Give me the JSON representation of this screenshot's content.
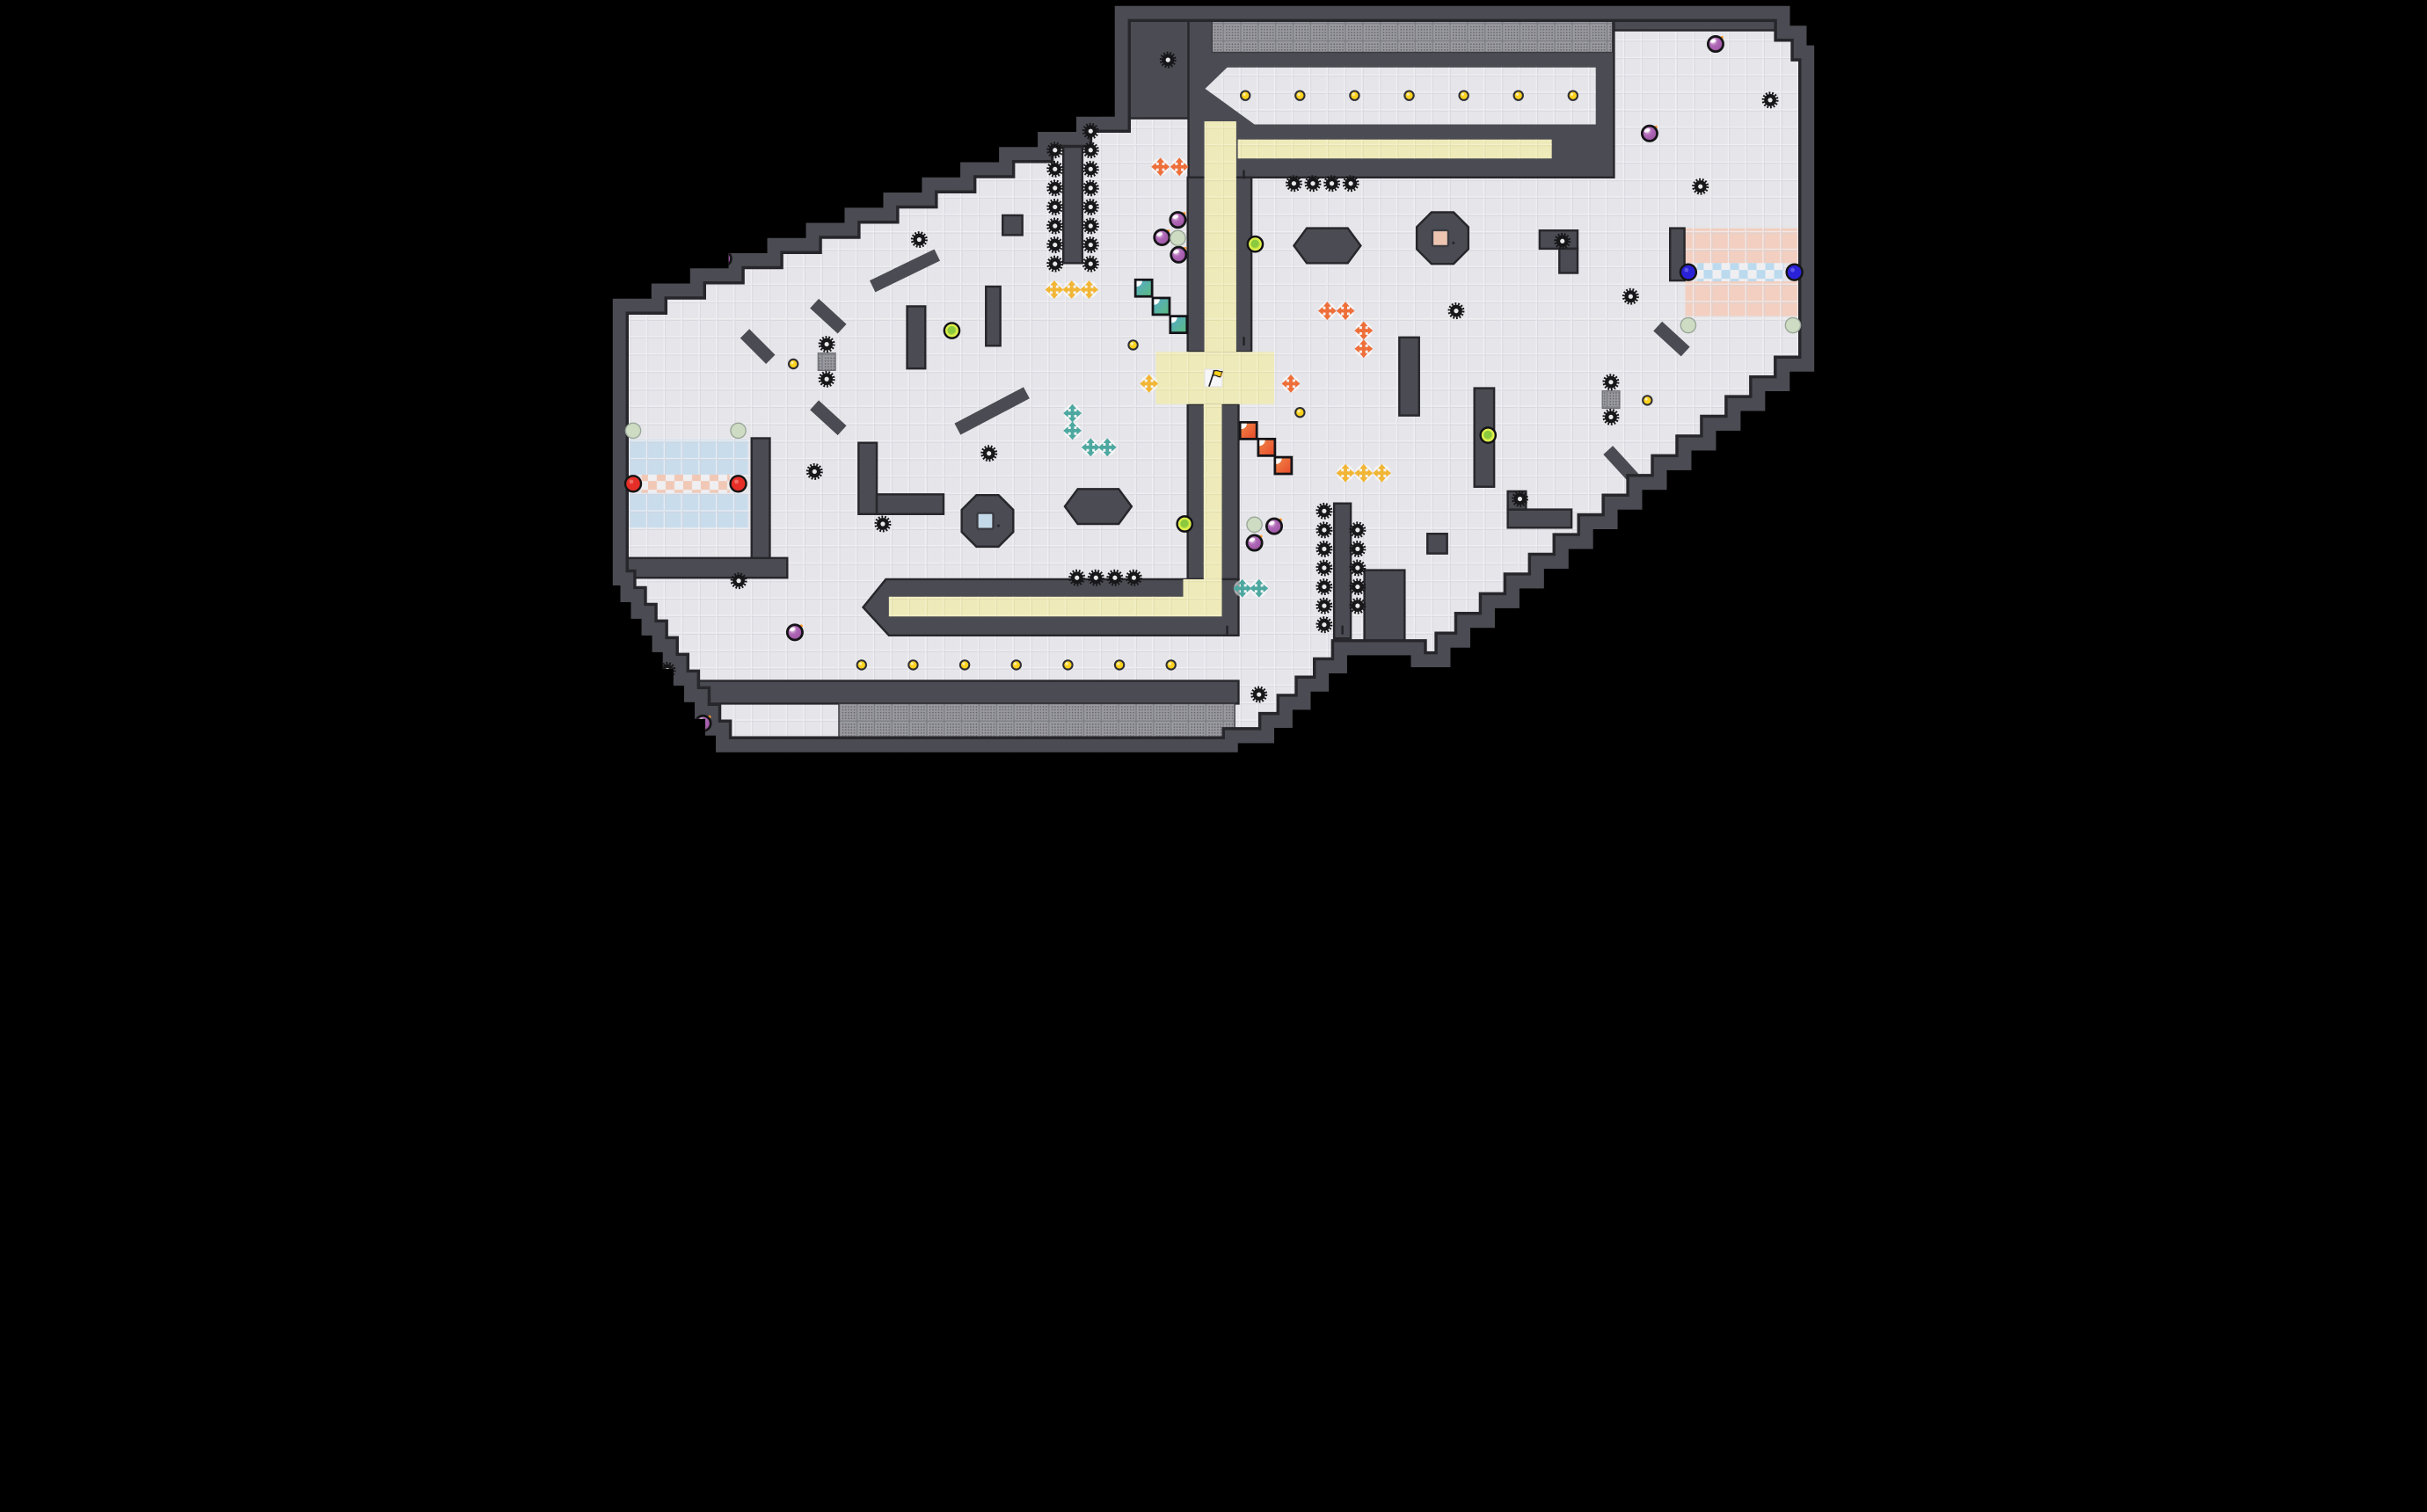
{
  "meta": {
    "view": "tile-level-map",
    "grid_cols": 80,
    "grid_rows": 50,
    "cell": 1.15
  },
  "palette": {
    "outside": "#000000",
    "floor": "#e6e6ea",
    "floor_line": "#d0d0d8",
    "wall": "#4b4b53",
    "wall_edge": "#26262b",
    "yellow_floor": "#eeeaba",
    "yellow_line": "#ddd79f",
    "blue_floor": "#c9dcec",
    "pink_floor": "#f2cfc0",
    "checker_pink": "#f1c8b6",
    "checker_blue": "#bcdaee",
    "checker_bg": "#efeff2",
    "hatch_bg": "#9a9aa0",
    "hatch_dot": "#64646b",
    "gold": "#ffd21e",
    "bomb_hi": "#f3e2ee",
    "bomb_mid": "#b06ab8",
    "bomb_edge": "#c06a88",
    "spark": "#ff9a2e",
    "gear": "#17171a",
    "gear_hole": "#e9e9ed",
    "powerup": "#dff04a",
    "powerup_core": "#8bc93e",
    "pale_circle": "#cddcc2",
    "boost_red": "#e62e28",
    "boost_blue": "#2a22d8",
    "cross_orange": "#ee6f3a",
    "cross_yellow": "#f2b636",
    "cross_teal": "#4da8a0",
    "fold_red_a": "#f08a48",
    "fold_red_b": "#e8482a",
    "fold_teal_a": "#55a8cf",
    "fold_teal_b": "#5cbc7c",
    "inset_blue": "#c3d9e9",
    "inset_pink": "#ecc4b0",
    "flag": "#ffd21e",
    "flag_tip": "#f5a623",
    "ink": "#1c1c1f"
  },
  "boundary": [
    [
      33.5,
      0.4
    ],
    [
      78,
      0.4
    ],
    [
      78,
      1.7
    ],
    [
      79.1,
      1.7
    ],
    [
      79.1,
      3.0
    ],
    [
      79.6,
      3.0
    ],
    [
      79.6,
      23.2
    ],
    [
      79.6,
      24.5
    ],
    [
      77.98,
      24.5
    ],
    [
      77.98,
      25.8
    ],
    [
      76.36,
      25.8
    ],
    [
      76.36,
      27.1
    ],
    [
      74.74,
      27.1
    ],
    [
      74.74,
      28.4
    ],
    [
      73.12,
      28.4
    ],
    [
      73.12,
      29.7
    ],
    [
      71.5,
      29.7
    ],
    [
      71.5,
      31.0
    ],
    [
      69.88,
      31.0
    ],
    [
      69.88,
      32.3
    ],
    [
      68.26,
      32.3
    ],
    [
      68.26,
      33.6
    ],
    [
      66.64,
      33.6
    ],
    [
      66.64,
      34.9
    ],
    [
      65.02,
      34.9
    ],
    [
      65.02,
      36.2
    ],
    [
      63.4,
      36.2
    ],
    [
      63.4,
      37.5
    ],
    [
      61.78,
      37.5
    ],
    [
      61.78,
      38.8
    ],
    [
      60.16,
      38.8
    ],
    [
      60.16,
      40.1
    ],
    [
      58.54,
      40.1
    ],
    [
      58.54,
      41.4
    ],
    [
      56.92,
      41.4
    ],
    [
      56.92,
      42.7
    ],
    [
      55.62,
      42.7
    ],
    [
      55.62,
      44.0
    ],
    [
      54.32,
      44.0
    ],
    [
      53.02,
      44.0
    ],
    [
      53.02,
      43.2
    ],
    [
      48.8,
      43.2
    ],
    [
      48.8,
      44.4
    ],
    [
      47.6,
      44.4
    ],
    [
      47.6,
      45.6
    ],
    [
      46.4,
      45.6
    ],
    [
      46.4,
      46.8
    ],
    [
      45.2,
      46.8
    ],
    [
      45.2,
      48.0
    ],
    [
      44.0,
      48.0
    ],
    [
      44.0,
      49.0
    ],
    [
      41.6,
      49.0
    ],
    [
      41.6,
      49.6
    ],
    [
      7.2,
      49.6
    ],
    [
      7.2,
      48.5
    ],
    [
      6.5,
      48.5
    ],
    [
      6.5,
      47.4
    ],
    [
      5.8,
      47.4
    ],
    [
      5.8,
      46.3
    ],
    [
      5.1,
      46.3
    ],
    [
      5.1,
      45.2
    ],
    [
      4.4,
      45.2
    ],
    [
      4.4,
      44.1
    ],
    [
      3.7,
      44.1
    ],
    [
      3.7,
      43.0
    ],
    [
      3.0,
      43.0
    ],
    [
      3.0,
      41.9
    ],
    [
      2.3,
      41.9
    ],
    [
      2.3,
      40.8
    ],
    [
      1.6,
      40.8
    ],
    [
      1.6,
      39.7
    ],
    [
      0.9,
      39.7
    ],
    [
      0.9,
      38.6
    ],
    [
      0.4,
      38.6
    ],
    [
      0.4,
      20.7
    ],
    [
      0.4,
      19.7
    ],
    [
      2.95,
      19.7
    ],
    [
      2.95,
      18.7
    ],
    [
      5.5,
      18.7
    ],
    [
      5.5,
      17.7
    ],
    [
      8.04,
      17.7
    ],
    [
      8.04,
      16.7
    ],
    [
      10.59,
      16.7
    ],
    [
      10.59,
      15.7
    ],
    [
      13.14,
      15.7
    ],
    [
      13.14,
      14.7
    ],
    [
      15.68,
      14.7
    ],
    [
      15.68,
      13.7
    ],
    [
      18.23,
      13.7
    ],
    [
      18.23,
      12.7
    ],
    [
      20.78,
      12.7
    ],
    [
      20.78,
      11.7
    ],
    [
      23.32,
      11.7
    ],
    [
      23.32,
      10.7
    ],
    [
      25.87,
      10.7
    ],
    [
      25.87,
      9.7
    ],
    [
      28.42,
      9.7
    ],
    [
      28.42,
      8.7
    ],
    [
      30.96,
      8.7
    ],
    [
      30.96,
      7.7
    ],
    [
      33.5,
      7.7
    ]
  ],
  "walls": {
    "rects": [
      [
        32.5,
        0.4,
        5.85,
        7.4
      ],
      [
        38.35,
        0.4,
        28.05,
        11.3
      ],
      [
        66.4,
        0.4,
        13.2,
        1.6
      ],
      [
        38.3,
        11.7,
        4.2,
        11.5
      ],
      [
        38.3,
        26.65,
        3.35,
        11.55
      ],
      [
        3,
        44.9,
        38.65,
        1.5
      ],
      [
        3,
        48.7,
        38.65,
        1.0
      ],
      [
        0.4,
        36.8,
        11.5,
        1.3
      ],
      [
        30.1,
        8.9,
        1.25,
        8.45
      ],
      [
        19.8,
        20.2,
        1.2,
        4.1
      ],
      [
        25.0,
        18.9,
        0.95,
        3.9
      ],
      [
        26.1,
        14.2,
        1.3,
        1.3
      ],
      [
        16.6,
        29.2,
        1.2,
        4.7
      ],
      [
        17.8,
        32.6,
        4.4,
        1.3
      ],
      [
        9.55,
        28.9,
        1.2,
        7.9
      ],
      [
        52.25,
        22.25,
        1.3,
        5.15
      ],
      [
        57.2,
        25.6,
        1.3,
        6.5
      ],
      [
        59.4,
        33.6,
        4.2,
        1.2
      ],
      [
        59.4,
        32.4,
        1.2,
        1.2
      ],
      [
        54.1,
        35.2,
        1.3,
        1.3
      ],
      [
        61.5,
        15.2,
        2.5,
        1.2
      ],
      [
        62.8,
        16.4,
        1.2,
        1.6
      ],
      [
        70.1,
        15.05,
        0.95,
        3.45
      ],
      [
        47.95,
        33.2,
        1.1,
        8.9
      ],
      [
        49.95,
        37.6,
        2.65,
        5.8
      ]
    ],
    "polys": [
      [
        [
          18.4,
          38.2
        ],
        [
          41.65,
          38.2
        ],
        [
          41.65,
          41.9
        ],
        [
          18.6,
          41.9
        ],
        [
          16.9,
          40.05
        ]
      ]
    ],
    "diagonals": [
      [
        17.9,
        18.7,
        21.4,
        17.0
      ],
      [
        14.0,
        20.3,
        15.2,
        21.4
      ],
      [
        9.4,
        22.3,
        10.5,
        23.4
      ],
      [
        23.5,
        28.1,
        27.3,
        26.1
      ],
      [
        14.0,
        27.0,
        15.2,
        28.1
      ],
      [
        69.6,
        21.8,
        70.8,
        22.9
      ],
      [
        66.3,
        30.0,
        67.4,
        31.2
      ]
    ],
    "hexagons": [
      {
        "cx": 47.5,
        "cy": 16.2
      },
      {
        "cx": 32.4,
        "cy": 33.4
      }
    ],
    "octagon_blocks": [
      {
        "cx": 25.1,
        "cy": 34.35,
        "inset": "inset_blue"
      },
      {
        "cx": 55.1,
        "cy": 15.7,
        "inset": "inset_pink"
      }
    ]
  },
  "floors": {
    "white_corridor_chevron": [
      [
        39.45,
        5.85
      ],
      [
        40.9,
        4.45
      ],
      [
        65.2,
        4.45
      ],
      [
        65.2,
        8.2
      ],
      [
        42.7,
        8.2
      ]
    ],
    "yellow": [
      [
        39.4,
        8.0,
        2.1,
        15.2
      ],
      [
        41.6,
        9.2,
        20.7,
        1.25
      ],
      [
        36.2,
        23.2,
        7.8,
        3.45
      ],
      [
        39.35,
        26.65,
        1.2,
        11.55
      ],
      [
        38.0,
        38.2,
        2.55,
        2.45
      ],
      [
        18.6,
        39.35,
        19.4,
        1.3
      ]
    ],
    "blue_rows": [
      [
        1.3,
        29.0,
        8.0,
        2.3
      ],
      [
        1.3,
        32.5,
        8.0,
        2.3
      ]
    ],
    "pink_rows": [
      [
        71.1,
        15.05,
        7.6,
        2.3
      ],
      [
        71.1,
        18.55,
        7.6,
        2.3
      ]
    ],
    "checker_pink": [
      [
        2.3,
        31.3,
        5.8,
        1.2
      ]
    ],
    "checker_blue": [
      [
        71.9,
        17.35,
        5.7,
        1.2
      ]
    ],
    "flag_tile": [
      39.42,
      24.35,
      1.15,
      1.15
    ]
  },
  "overlays": {
    "hatched_strips": [
      [
        39.9,
        1.3,
        26.4,
        2.15
      ],
      [
        15.3,
        46.4,
        26.1,
        2.3
      ]
    ],
    "dotted_blocks": [
      [
        13.93,
        23.28
      ],
      [
        65.63,
        25.78
      ]
    ],
    "door_ticks": [
      [
        42.0,
        11.5
      ],
      [
        42.0,
        22.5
      ],
      [
        40.9,
        41.55
      ],
      [
        48.5,
        41.55
      ]
    ]
  },
  "entities": {
    "flag": {
      "x": 40.0,
      "y": 24.95
    },
    "gold": [
      [
        42.1,
        6.3
      ],
      [
        45.7,
        6.3
      ],
      [
        49.3,
        6.3
      ],
      [
        52.9,
        6.3
      ],
      [
        56.5,
        6.3
      ],
      [
        60.1,
        6.3
      ],
      [
        63.7,
        6.3
      ],
      [
        16.8,
        43.85
      ],
      [
        20.2,
        43.85
      ],
      [
        23.6,
        43.85
      ],
      [
        27.0,
        43.85
      ],
      [
        30.4,
        43.85
      ],
      [
        33.8,
        43.85
      ],
      [
        37.2,
        43.85
      ],
      [
        34.7,
        22.75
      ],
      [
        45.7,
        27.2
      ],
      [
        12.3,
        24.0
      ],
      [
        68.6,
        26.4
      ]
    ],
    "bombs": [
      [
        8.9,
        16.0
      ],
      [
        7.7,
        17.05
      ],
      [
        36.6,
        15.65
      ],
      [
        37.65,
        14.5
      ],
      [
        37.7,
        16.8
      ],
      [
        42.7,
        35.8
      ],
      [
        44.0,
        34.7
      ],
      [
        73.1,
        2.9
      ],
      [
        68.75,
        8.8
      ],
      [
        72.3,
        34.65
      ],
      [
        12.4,
        41.7
      ],
      [
        6.35,
        47.7
      ]
    ],
    "gears": [
      [
        37,
        3.95
      ],
      [
        29.55,
        9.9
      ],
      [
        29.55,
        11.15
      ],
      [
        29.55,
        12.4
      ],
      [
        29.55,
        13.65
      ],
      [
        29.55,
        14.9
      ],
      [
        29.55,
        16.15
      ],
      [
        29.55,
        17.4
      ],
      [
        31.9,
        8.65
      ],
      [
        31.9,
        9.9
      ],
      [
        31.9,
        11.15
      ],
      [
        31.9,
        12.4
      ],
      [
        31.9,
        13.65
      ],
      [
        31.9,
        14.9
      ],
      [
        31.9,
        16.15
      ],
      [
        31.9,
        17.4
      ],
      [
        45.3,
        12.1
      ],
      [
        46.55,
        12.1
      ],
      [
        47.8,
        12.1
      ],
      [
        49.05,
        12.1
      ],
      [
        20.6,
        15.8
      ],
      [
        63.0,
        15.9
      ],
      [
        72.1,
        12.3
      ],
      [
        76.7,
        6.6
      ],
      [
        67.5,
        19.55
      ],
      [
        56.0,
        20.5
      ],
      [
        14.5,
        22.7
      ],
      [
        14.5,
        25.0
      ],
      [
        66.2,
        25.2
      ],
      [
        66.2,
        27.5
      ],
      [
        13.7,
        31.1
      ],
      [
        25.2,
        29.9
      ],
      [
        18.2,
        34.55
      ],
      [
        8.7,
        38.3
      ],
      [
        4.0,
        44.2
      ],
      [
        60.2,
        32.9
      ],
      [
        43.0,
        45.8
      ],
      [
        31.0,
        38.1
      ],
      [
        32.25,
        38.1
      ],
      [
        33.5,
        38.1
      ],
      [
        34.75,
        38.1
      ],
      [
        47.3,
        33.7
      ],
      [
        47.3,
        34.95
      ],
      [
        47.3,
        36.2
      ],
      [
        47.3,
        37.45
      ],
      [
        47.3,
        38.7
      ],
      [
        47.3,
        39.95
      ],
      [
        47.3,
        41.2
      ],
      [
        49.5,
        34.95
      ],
      [
        49.5,
        36.2
      ],
      [
        49.5,
        37.45
      ],
      [
        49.5,
        38.7
      ],
      [
        49.5,
        39.95
      ]
    ],
    "crosses_orange": [
      [
        36.5,
        11.0
      ],
      [
        37.75,
        11.0
      ],
      [
        47.5,
        20.5
      ],
      [
        48.7,
        20.5
      ],
      [
        49.9,
        21.8
      ],
      [
        49.9,
        23.0
      ],
      [
        45.1,
        25.3
      ]
    ],
    "crosses_yellow": [
      [
        29.5,
        19.1
      ],
      [
        30.65,
        19.1
      ],
      [
        31.8,
        19.1
      ],
      [
        35.75,
        25.3
      ],
      [
        48.7,
        31.2
      ],
      [
        49.9,
        31.2
      ],
      [
        51.1,
        31.2
      ]
    ],
    "crosses_teal": [
      [
        30.7,
        27.25
      ],
      [
        30.7,
        28.4
      ],
      [
        31.9,
        29.5
      ],
      [
        33.0,
        29.5
      ],
      [
        41.9,
        38.8
      ],
      [
        43.0,
        38.8
      ]
    ],
    "fold_teal": [
      [
        35.4,
        19.0
      ],
      [
        36.55,
        20.2
      ],
      [
        37.7,
        21.4
      ]
    ],
    "fold_red": [
      [
        42.3,
        28.4
      ],
      [
        43.5,
        29.5
      ],
      [
        44.6,
        30.7
      ]
    ],
    "powerups": [
      [
        22.75,
        21.8
      ],
      [
        42.75,
        16.1
      ],
      [
        58.1,
        28.7
      ],
      [
        38.1,
        34.55
      ]
    ],
    "pale_circles": [
      [
        37.65,
        15.7
      ],
      [
        42.7,
        34.6
      ],
      [
        1.74,
        28.4
      ],
      [
        8.67,
        28.4
      ],
      [
        71.3,
        21.45
      ],
      [
        78.2,
        21.45
      ]
    ],
    "boost_red": [
      [
        1.74,
        31.9
      ],
      [
        8.67,
        31.9
      ]
    ],
    "boost_blue": [
      [
        71.3,
        17.95
      ],
      [
        78.3,
        17.95
      ]
    ]
  }
}
